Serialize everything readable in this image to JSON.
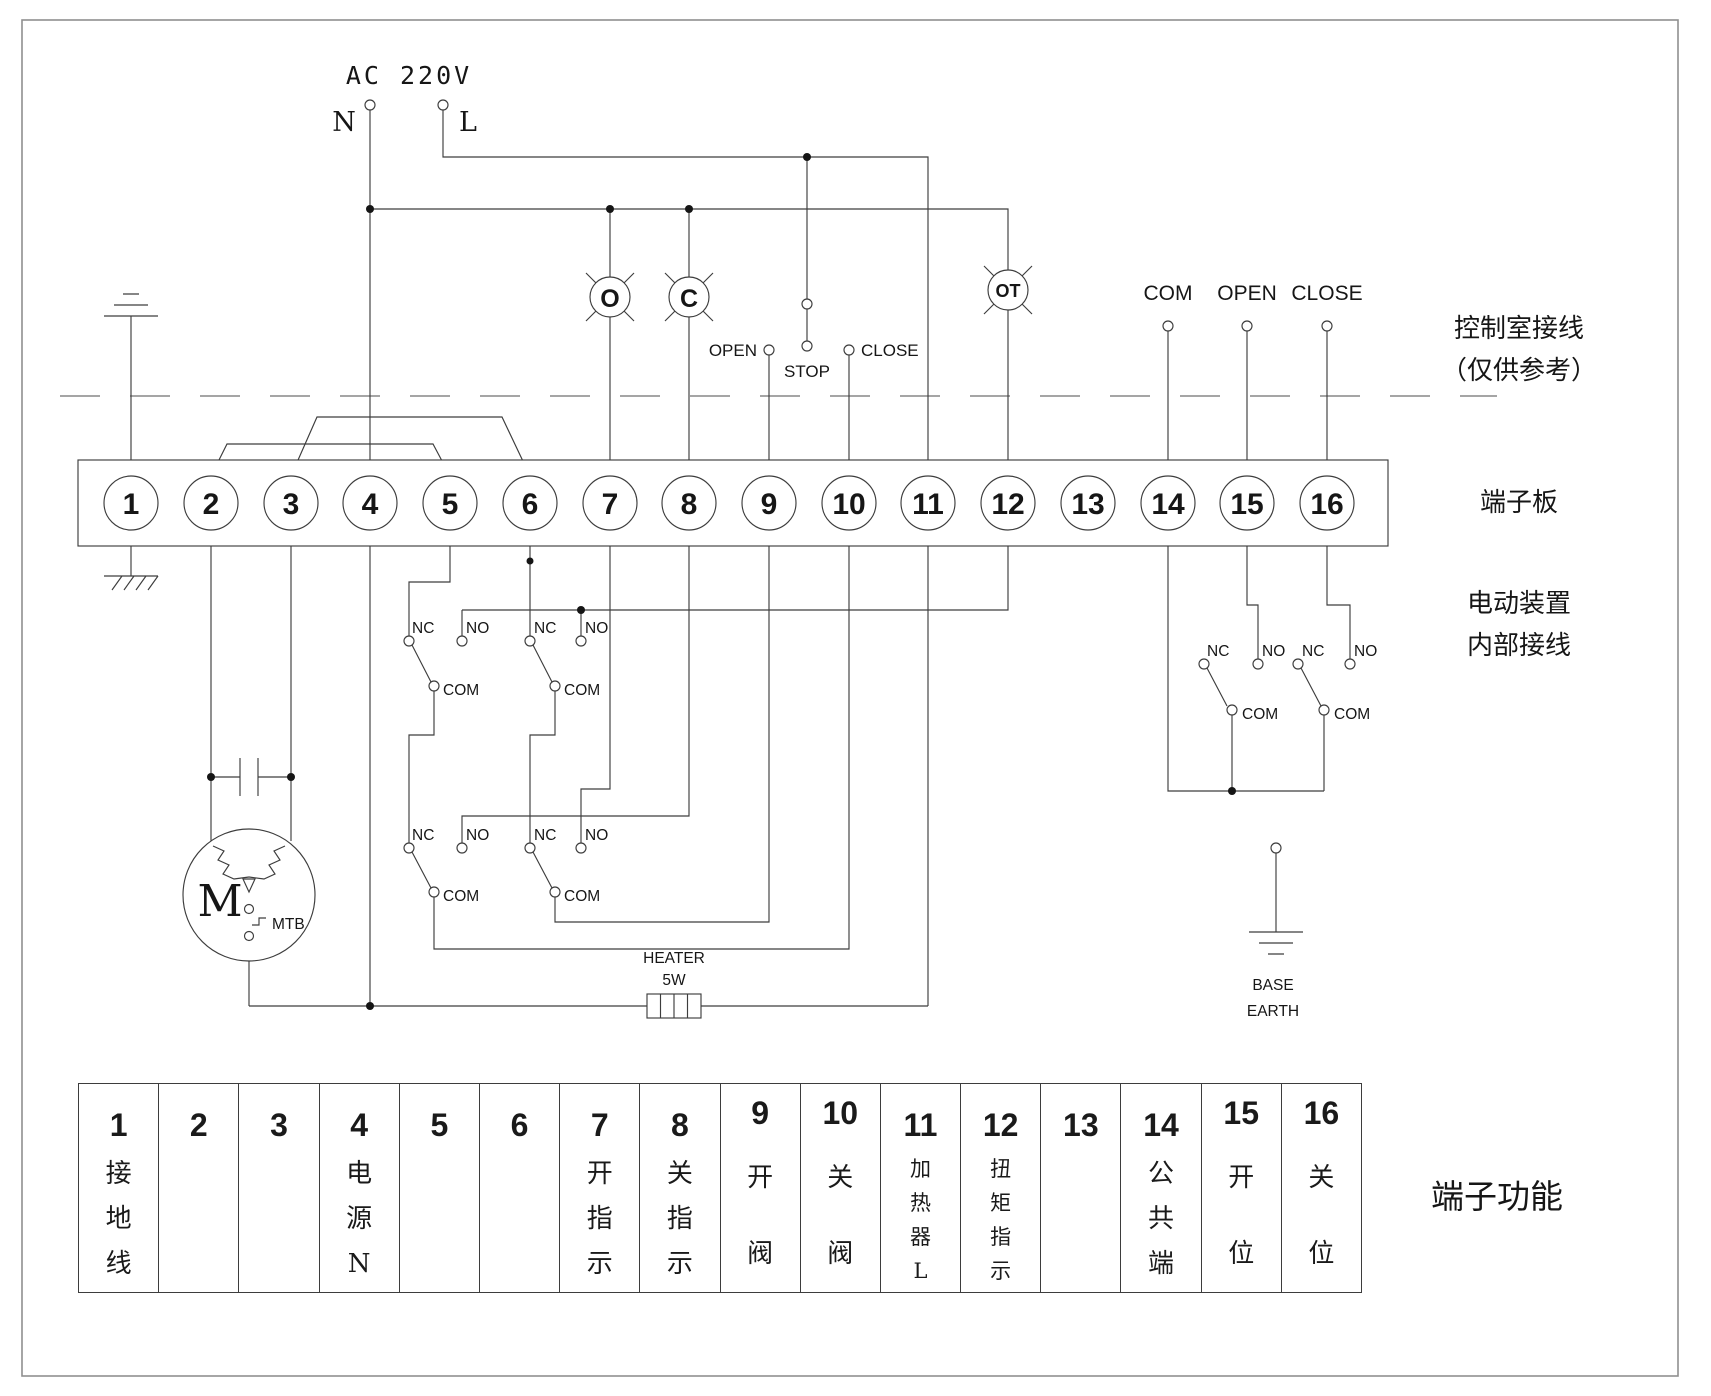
{
  "colors": {
    "background": "#ffffff",
    "line": "#3d3d3d",
    "text": "#161616"
  },
  "power": {
    "label": "AC 220V",
    "neutral": "N",
    "live": "L"
  },
  "control_room": {
    "note_line1": "控制室接线",
    "note_line2": "（仅供参考）",
    "buttons": {
      "open": "OPEN",
      "stop": "STOP",
      "close": "CLOSE"
    },
    "remote_terminals": {
      "com": "COM",
      "open": "OPEN",
      "close": "CLOSE"
    }
  },
  "lamps": {
    "open": "O",
    "close": "C",
    "over_torque": "OT"
  },
  "terminal_board": {
    "label": "端子板",
    "terminals": [
      "1",
      "2",
      "3",
      "4",
      "5",
      "6",
      "7",
      "8",
      "9",
      "10",
      "11",
      "12",
      "13",
      "14",
      "15",
      "16"
    ]
  },
  "internal": {
    "label_line1": "电动装置",
    "label_line2": "内部接线",
    "switch": {
      "nc": "NC",
      "no": "NO",
      "com": "COM"
    },
    "motor": {
      "label": "M",
      "thermal": "MTB"
    },
    "heater": {
      "line1": "HEATER",
      "line2": "5W"
    },
    "base_earth": {
      "line1": "BASE",
      "line2": "EARTH"
    }
  },
  "function_table": {
    "title": "端子功能",
    "columns": [
      {
        "num": "1",
        "function": "接地线"
      },
      {
        "num": "2",
        "function": ""
      },
      {
        "num": "3",
        "function": ""
      },
      {
        "num": "4",
        "function": "电源N"
      },
      {
        "num": "5",
        "function": ""
      },
      {
        "num": "6",
        "function": ""
      },
      {
        "num": "7",
        "function": "开指示"
      },
      {
        "num": "8",
        "function": "关指示"
      },
      {
        "num": "9",
        "function": "开阀"
      },
      {
        "num": "10",
        "function": "关阀"
      },
      {
        "num": "11",
        "function": "加热器L"
      },
      {
        "num": "12",
        "function": "扭矩指示"
      },
      {
        "num": "13",
        "function": ""
      },
      {
        "num": "14",
        "function": "公共端"
      },
      {
        "num": "15",
        "function": "开位"
      },
      {
        "num": "16",
        "function": "关位"
      }
    ]
  }
}
